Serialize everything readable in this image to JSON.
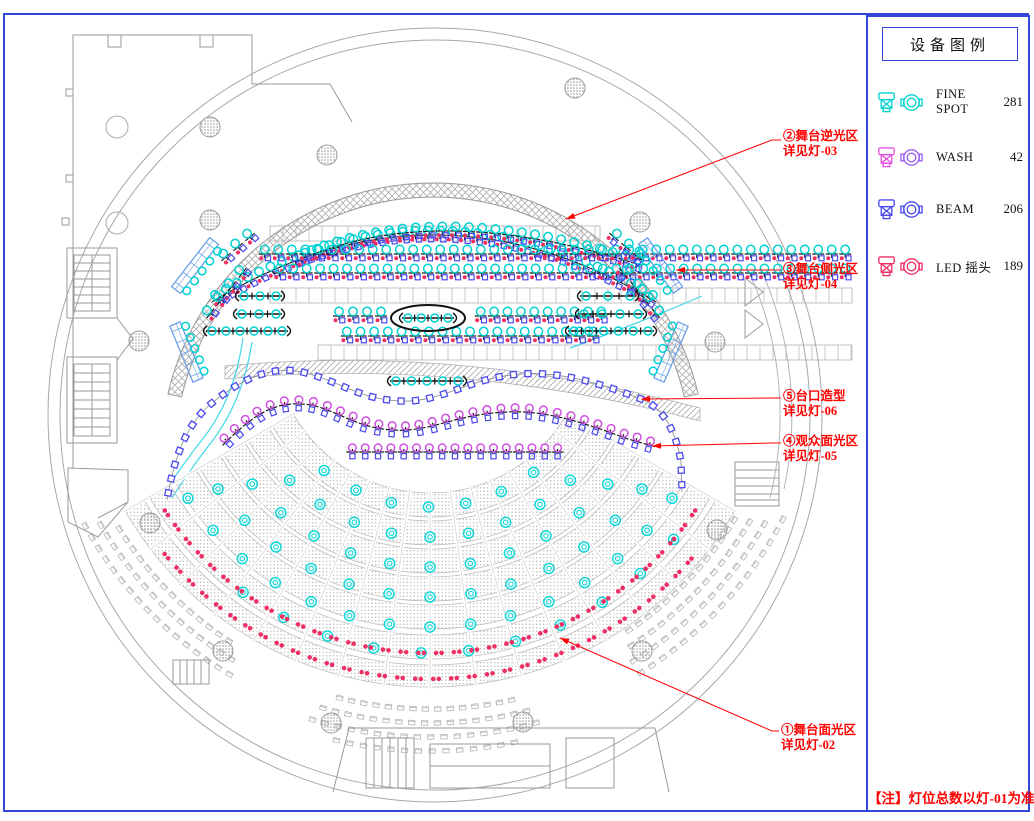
{
  "legend": {
    "title": "设备图例",
    "note": "【注】灯位总数以灯-01为准",
    "items": [
      {
        "name": "FINE SPOT",
        "count": "281",
        "c1": "#00d2d2",
        "c2": "#00d2d2"
      },
      {
        "name": "WASH",
        "count": "42",
        "c1": "#e253e2",
        "c2": "#9a5cf0"
      },
      {
        "name": "BEAM",
        "count": "206",
        "c1": "#4a4af0",
        "c2": "#4a4af0"
      },
      {
        "name": "LED 摇头",
        "count": "189",
        "c1": "#ee2f64",
        "c2": "#ee2f64"
      }
    ]
  },
  "annotations": [
    {
      "line1": "②舞台逆光区",
      "line2": "详见灯-03",
      "label": [
        783,
        129
      ],
      "elbow": [
        772,
        140
      ],
      "arrow": [
        566,
        219
      ]
    },
    {
      "line1": "③舞台侧光区",
      "line2": "详见灯-04",
      "label": [
        783,
        262
      ],
      "elbow": [
        772,
        270
      ],
      "arrow": [
        676,
        270
      ]
    },
    {
      "line1": "⑤台口造型",
      "line2": "详见灯-06",
      "label": [
        783,
        389
      ],
      "elbow": [
        772,
        398
      ],
      "arrow": [
        641,
        399
      ]
    },
    {
      "line1": "④观众面光区",
      "line2": "详见灯-05",
      "label": [
        783,
        434
      ],
      "elbow": [
        772,
        443
      ],
      "arrow": [
        652,
        446
      ]
    },
    {
      "line1": "①舞台面光区",
      "line2": "详见灯-02",
      "label": [
        781,
        723
      ],
      "elbow": [
        772,
        731
      ],
      "arrow": [
        560,
        638
      ]
    }
  ],
  "plan": {
    "colors": {
      "cyan": "#00d2d2",
      "blue": "#4a4af0",
      "purple": "#cf4fe0",
      "red": "#ee2f64",
      "anno": "#ff0000",
      "frame": "#3348d8",
      "ladder": "#6aa0e8",
      "gray": "#9a9a9a"
    },
    "rows": [
      {
        "t": "mix",
        "d": "M212,302 Q433,168 656,302",
        "n": 38
      },
      {
        "t": "mix",
        "d": "M295,262 Q433,198 643,266",
        "n": 27
      },
      {
        "t": "mix",
        "d": "M258,254 H852",
        "n": 44
      },
      {
        "t": "mix",
        "d": "M273,273 H852",
        "n": 43
      },
      {
        "t": "mix",
        "d": "M332,316 H388",
        "n": 4
      },
      {
        "t": "mix",
        "d": "M474,316 H608",
        "n": 10
      },
      {
        "t": "mix",
        "d": "M340,336 H600",
        "n": 19
      },
      {
        "t": "mix",
        "d": "M205,320 L248,266",
        "n": 4
      },
      {
        "t": "mix",
        "d": "M220,262 L256,232",
        "n": 3
      },
      {
        "t": "mix",
        "d": "M618,266 L661,320",
        "n": 4
      },
      {
        "t": "mix",
        "d": "M608,232 L644,262",
        "n": 3
      },
      {
        "t": "wash",
        "d": "M222,446 C252,416 272,403 300,404 C332,405 352,428 394,430 C432,432 455,414 508,412 C548,410 590,425 625,438 L656,447",
        "n": 33
      },
      {
        "t": "wash",
        "d": "M346,452 H564",
        "n": 17
      },
      {
        "t": "chain",
        "d": "M167,500 C174,458 186,424 212,403 C246,375 276,366 302,372 C340,381 358,399 400,401 C442,403 468,378 520,374 C562,371 602,384 641,399 C664,408 676,432 681,462 L682,492",
        "n": 46
      }
    ],
    "cyanbats": [
      [
        234,
        296,
        286,
        296,
        3
      ],
      [
        232,
        314,
        286,
        314,
        3
      ],
      [
        202,
        331,
        292,
        331,
        6
      ],
      [
        576,
        296,
        640,
        296,
        3
      ],
      [
        574,
        314,
        648,
        314,
        4
      ],
      [
        564,
        331,
        658,
        331,
        6
      ],
      [
        398,
        318,
        458,
        318,
        4
      ],
      [
        386,
        381,
        468,
        381,
        5
      ]
    ],
    "ladders": [
      [
        176,
        290,
        214,
        241,
        5
      ],
      [
        175,
        324,
        198,
        380,
        5
      ],
      [
        643,
        241,
        678,
        290,
        5
      ],
      [
        683,
        324,
        659,
        380,
        5
      ]
    ],
    "audience": {
      "cx": 430,
      "cy": 335,
      "a1": 30,
      "a2": 150,
      "aisleStep": 7.5,
      "bands": [
        [
          158,
          182
        ],
        [
          186,
          210
        ],
        [
          214,
          238
        ],
        [
          242,
          266
        ],
        [
          270,
          294
        ],
        [
          300,
          324
        ],
        [
          330,
          352
        ]
      ],
      "spotRings": [
        [
          172,
          128,
          52,
          12.5
        ],
        [
          202,
          134,
          46,
          11
        ],
        [
          232,
          140,
          40,
          10
        ],
        [
          262,
          144,
          36,
          9
        ],
        [
          292,
          146,
          34,
          8
        ],
        [
          318,
          126,
          40,
          8.6
        ]
      ],
      "redArcs": [
        [
          318,
          146,
          34,
          3.2
        ],
        [
          344,
          140,
          40,
          3.0
        ]
      ],
      "seatArcs": [
        [
          366,
          148,
          122
        ],
        [
          380,
          150,
          121
        ],
        [
          394,
          151,
          120
        ],
        [
          356,
          56,
          30
        ],
        [
          370,
          57,
          29
        ],
        [
          384,
          58,
          28
        ],
        [
          398,
          58,
          27
        ],
        [
          374,
          104,
          77
        ],
        [
          388,
          106,
          75
        ],
        [
          402,
          107,
          74
        ],
        [
          416,
          103,
          77
        ]
      ],
      "seatStep": 1.9
    },
    "columns": {
      "hatched": [
        [
          210,
          127
        ],
        [
          210,
          220
        ],
        [
          327,
          155
        ],
        [
          575,
          88
        ],
        [
          640,
          222
        ],
        [
          715,
          342
        ],
        [
          139,
          341
        ],
        [
          150,
          523
        ],
        [
          223,
          651
        ],
        [
          331,
          723
        ],
        [
          523,
          722
        ],
        [
          642,
          651
        ],
        [
          717,
          530
        ]
      ],
      "plain": [
        [
          117,
          127
        ],
        [
          117,
          223
        ]
      ]
    },
    "truss": {
      "cx": 433,
      "cy": 455,
      "r1": 258,
      "r2": 272,
      "a1": 193,
      "a2": 347
    },
    "deck": [
      [
        270,
        600,
        226
      ],
      [
        270,
        852,
        288
      ],
      [
        318,
        852,
        345
      ]
    ],
    "ellipse": [
      428,
      318,
      37,
      13
    ],
    "apron": "M225,366 Q460,344 700,408 L700,421 Q460,357 225,379 Z",
    "curves": [
      "M252,342 Q243,400 213,440 Q191,468 172,498",
      "M243,338 Q235,396 205,436 Q184,462 165,492",
      "M570,348 Q642,322 702,296"
    ]
  }
}
